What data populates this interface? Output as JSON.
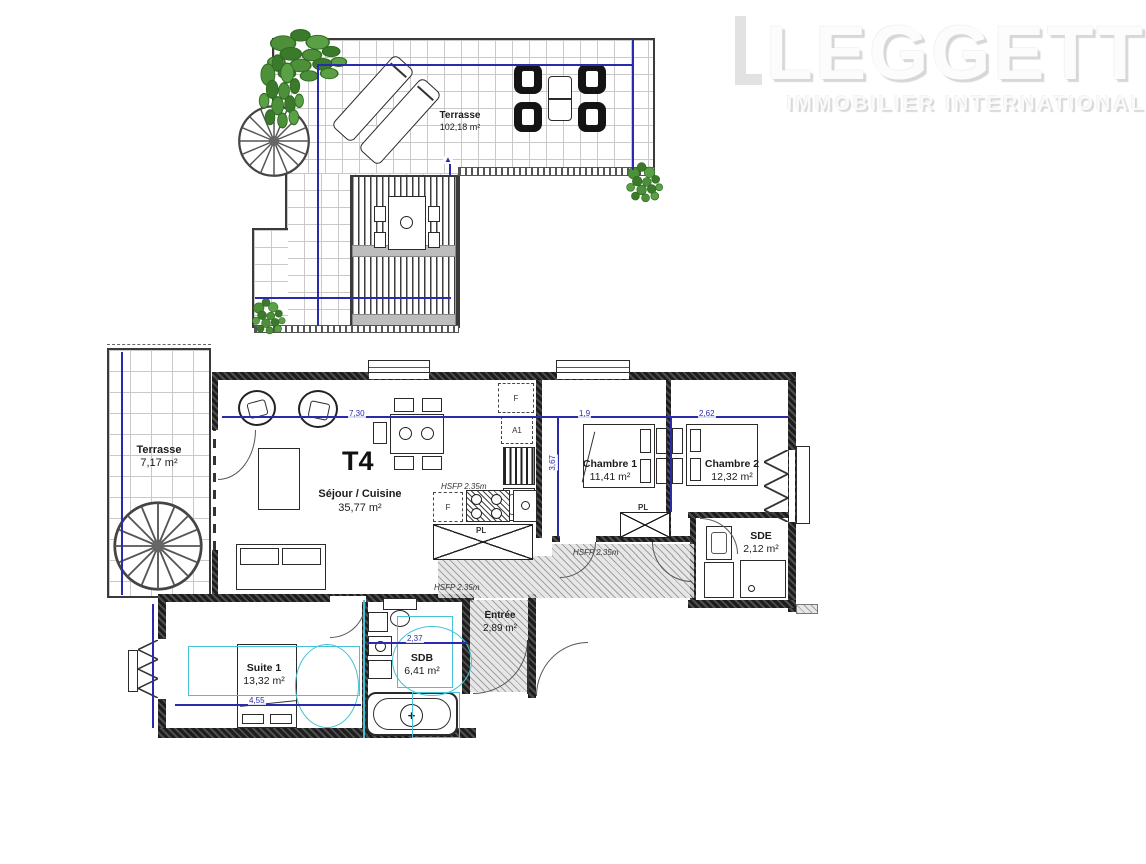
{
  "logo": {
    "name": "LEGGETT",
    "subtitle": "IMMOBILIER  INTERNATIONAL"
  },
  "roof": {
    "terrace_label": "Terrasse",
    "terrace_area": "102,18 m²"
  },
  "apartment": {
    "type": "T4",
    "sejour": {
      "label": "Séjour / Cuisine",
      "area": "35,77 m²"
    },
    "chambre1": {
      "label": "Chambre 1",
      "area": "11,41 m²"
    },
    "chambre2": {
      "label": "Chambre 2",
      "area": "12,32 m²"
    },
    "sde": {
      "label": "SDE",
      "area": "2,12 m²"
    },
    "entree": {
      "label": "Entrée",
      "area": "2,89 m²"
    },
    "suite1": {
      "label": "Suite 1",
      "area": "13,32 m²"
    },
    "sdb": {
      "label": "SDB",
      "area": "6,41 m²"
    },
    "terrasse": {
      "label": "Terrasse",
      "area": "7,17 m²"
    }
  },
  "annotations": {
    "hsfp": "HSFP 2.35m",
    "closet": "PL",
    "fridge": "F",
    "appliance": "A1"
  },
  "fixtures": {
    "tap_symbol": "+"
  },
  "dimensions": {
    "living_width": "7,30",
    "chambre1_width": "1,9",
    "chambre2_width": "2,62",
    "rooms_depth": "3,67",
    "suite_width": "4,55",
    "sdb_width": "2,37"
  },
  "colors": {
    "dimension_blue": "#2a2ab0",
    "overlay_cyan": "#45c2d8",
    "plant_green": "#4e8f3a",
    "wall_dark": "#2e2e2e",
    "tile_grid": "#c9c9c9"
  }
}
